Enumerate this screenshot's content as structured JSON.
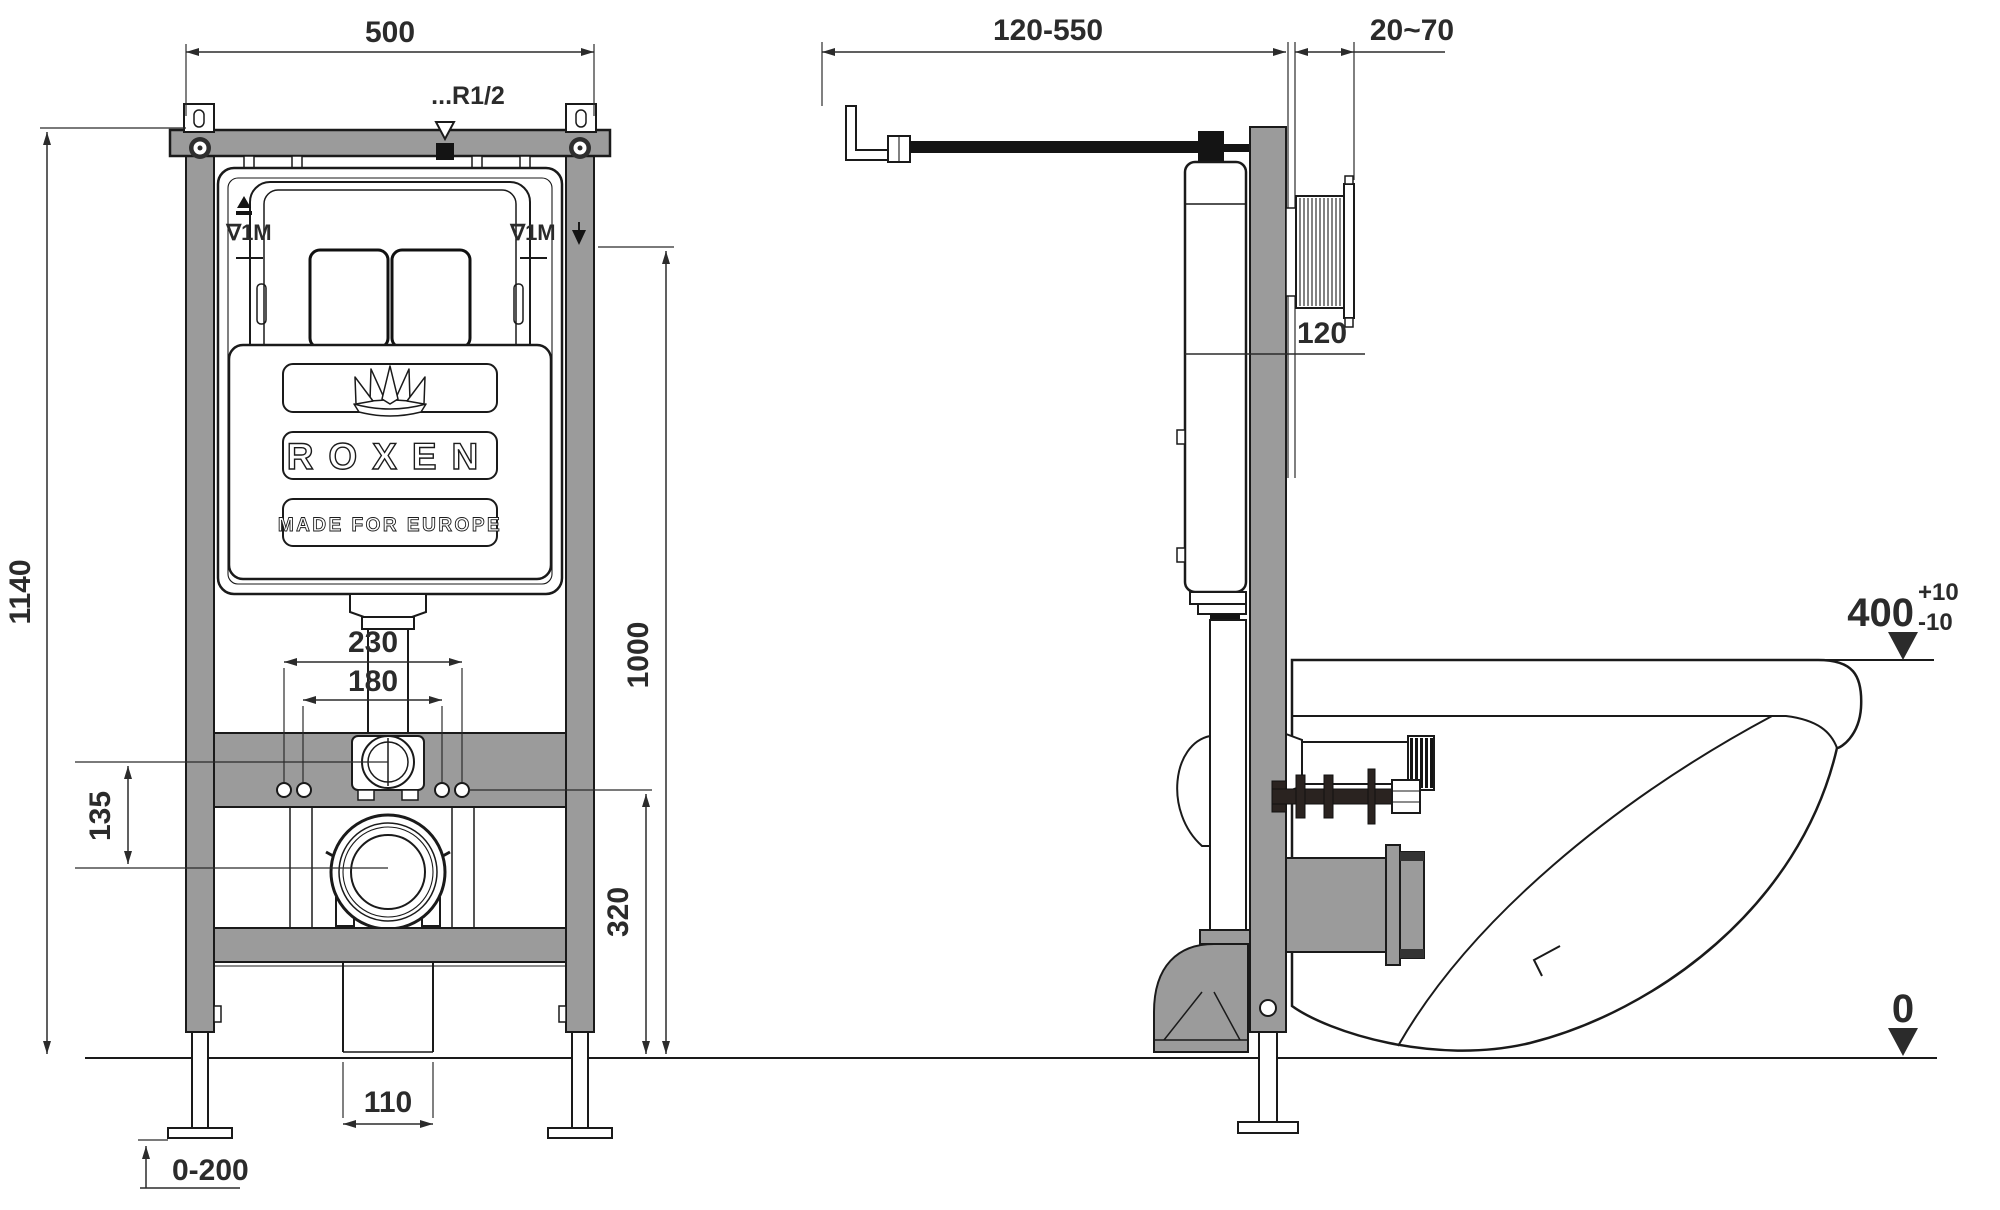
{
  "drawing": {
    "title": "Roxen wall-hung toilet installation frame — dimensional drawing",
    "colors": {
      "frame_gray": "#9b9b9b",
      "outline": "#1a1a1a",
      "dim_text": "#2b2b2b",
      "background": "#ffffff",
      "bolt_dark": "#2a2320"
    },
    "front_view": {
      "dim_width_top": "500",
      "dim_height_overall": "1140",
      "dim_holes_outer": "230",
      "dim_holes_inner": "180",
      "dim_fitting_to_drain": "135",
      "dim_top_to_floor": "1000",
      "dim_holes_to_floor": "320",
      "dim_outlet_width": "110",
      "dim_feet_adjust": "0-200",
      "label_water_thread": "...R1/2",
      "label_level_left": "∇1M",
      "label_level_right": "∇1M",
      "logo_brand": "ROXEN",
      "logo_tagline": "MADE FOR EUROPE"
    },
    "side_view": {
      "dim_supply_range": "120-550",
      "dim_plate_depth": "20~70",
      "dim_cistern_depth": "120",
      "dim_bowl_top_height": "400",
      "tol_plus": "+10",
      "tol_minus": "-10",
      "dim_floor_level": "0"
    },
    "icons": {
      "crown": "crown-icon",
      "pressure": "pressure-test-icon",
      "level_mark_rail": "level-mark-icon",
      "water_inlet_marker": "water-inlet-square-icon",
      "inlet_triangle": "inlet-triangle-icon",
      "level_triangle_400": "level-triangle-icon",
      "level_triangle_0": "level-triangle-icon"
    }
  }
}
